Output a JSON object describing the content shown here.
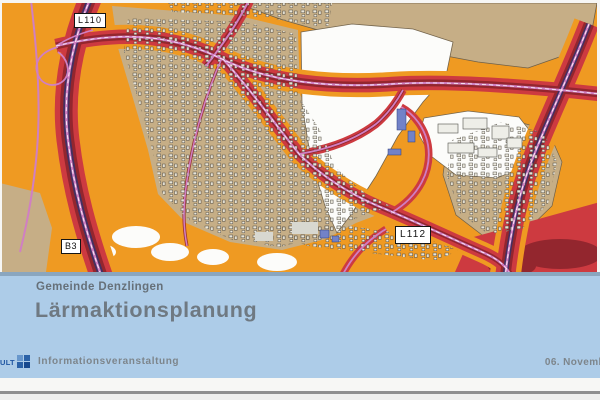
{
  "slide": {
    "subtitle": "Gemeinde Denzlingen",
    "title": "Lärmaktionsplanung"
  },
  "footer": {
    "logo_text": "ULT",
    "event_label": "Informationsveranstaltung",
    "date_label": "06. Novemb"
  },
  "map": {
    "labels": {
      "l110": "L110",
      "b3": "B3",
      "l112": "L112"
    },
    "palette": {
      "noise_low_orange": "#ef9a22",
      "noise_mid_red": "#cd3a40",
      "noise_high_dark_red": "#93262e",
      "noise_highest_purple": "#443061",
      "road_pink": "#d07fc2",
      "urban_tan": "#c6ae86",
      "band_blue": "#adcce8",
      "divider_blue_gray": "#8aa6bf",
      "title_text_gray": "#6f7982",
      "logo_blue": "#1f56a2"
    }
  }
}
